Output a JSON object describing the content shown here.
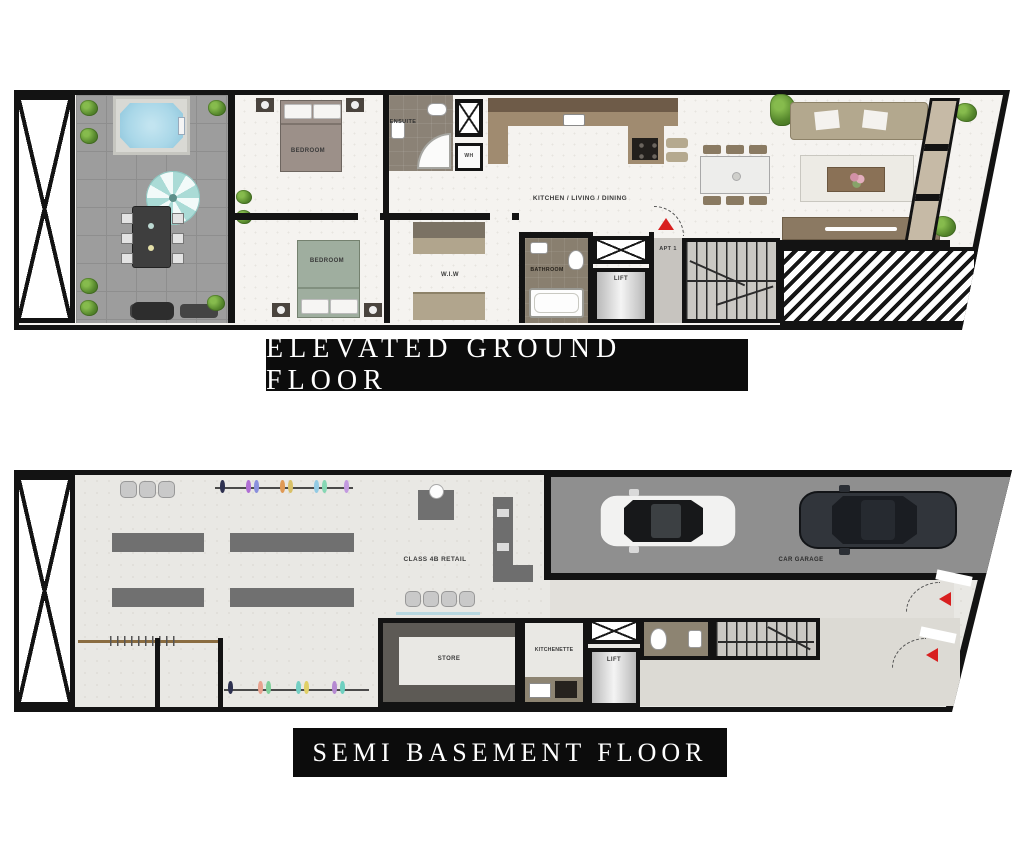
{
  "floors": {
    "ground": {
      "title": "ELEVATED GROUND FLOOR",
      "labels": {
        "bedroom1": "BEDROOM",
        "bedroom2": "BEDROOM",
        "ensuite": "ENSUITE",
        "wh": "WH",
        "kitchen": "KITCHEN / LIVING / DINING",
        "wiw": "W.I.W",
        "bathroom": "BATHROOM",
        "lift": "LIFT",
        "apt": "APT 1"
      }
    },
    "basement": {
      "title": "SEMI BASEMENT FLOOR",
      "labels": {
        "retail": "CLASS 4B RETAIL",
        "garage": "CAR GARAGE",
        "store": "STORE",
        "kitchenette": "KITCHENETTE",
        "lift": "LIFT"
      }
    }
  },
  "colors": {
    "wall_black": "#131313",
    "banner_bg": "#0c0c0c",
    "banner_text": "#ffffff",
    "entry_arrow_red": "#d81f1f",
    "pool_blue": "#a9d7e8",
    "terrace_gray": "#9d9d9d",
    "garage_floor_gray": "#8f8f8f",
    "counter_brown": "#a08b70",
    "shelf_gray": "#5d5a55"
  }
}
